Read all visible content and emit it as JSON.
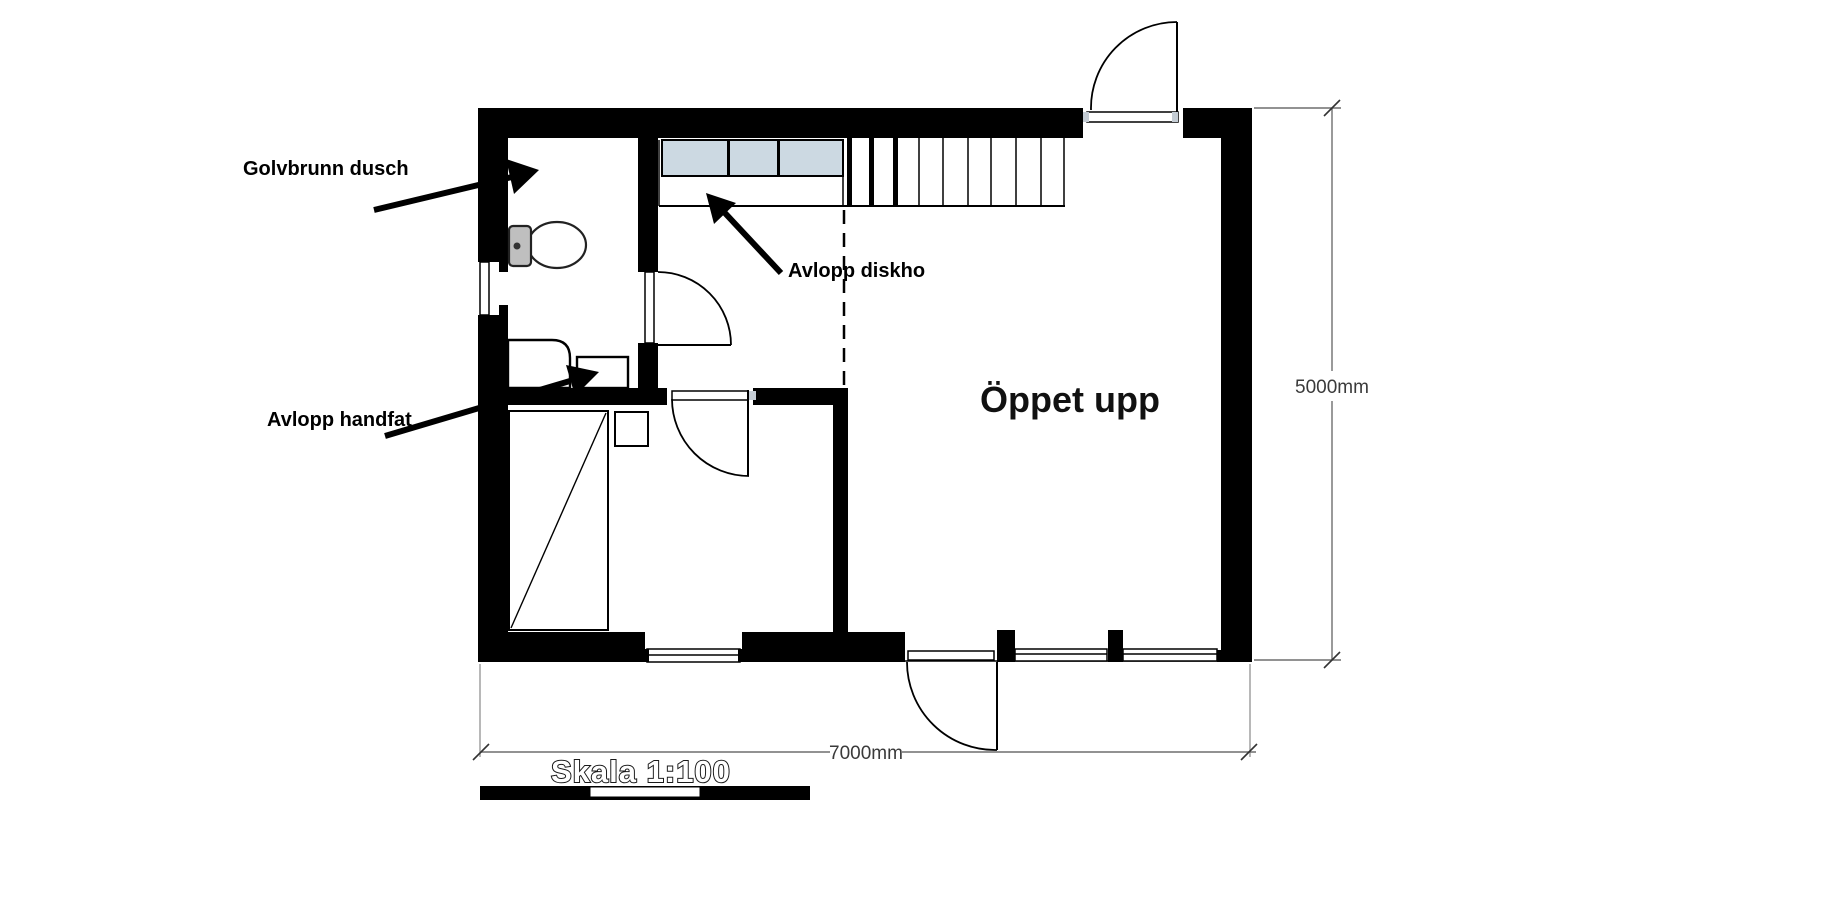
{
  "annotations": {
    "golvbrunn_dusch": "Golvbrunn dusch",
    "avlopp_diskho": "Avlopp diskho",
    "avlopp_handfat": "Avlopp handfat",
    "oppet_upp": "Öppet upp"
  },
  "dimensions": {
    "right_wall": "5000mm",
    "bottom_wall": "7000mm"
  },
  "scale": {
    "label": "Skala 1:100"
  },
  "colors": {
    "wall": "#000000",
    "cabinet_fill": "#ccd9e2",
    "hinge_fill": "#c4ccd4",
    "dimension_line": "#6f6f6f",
    "dimension_text": "#3a3a3a"
  }
}
